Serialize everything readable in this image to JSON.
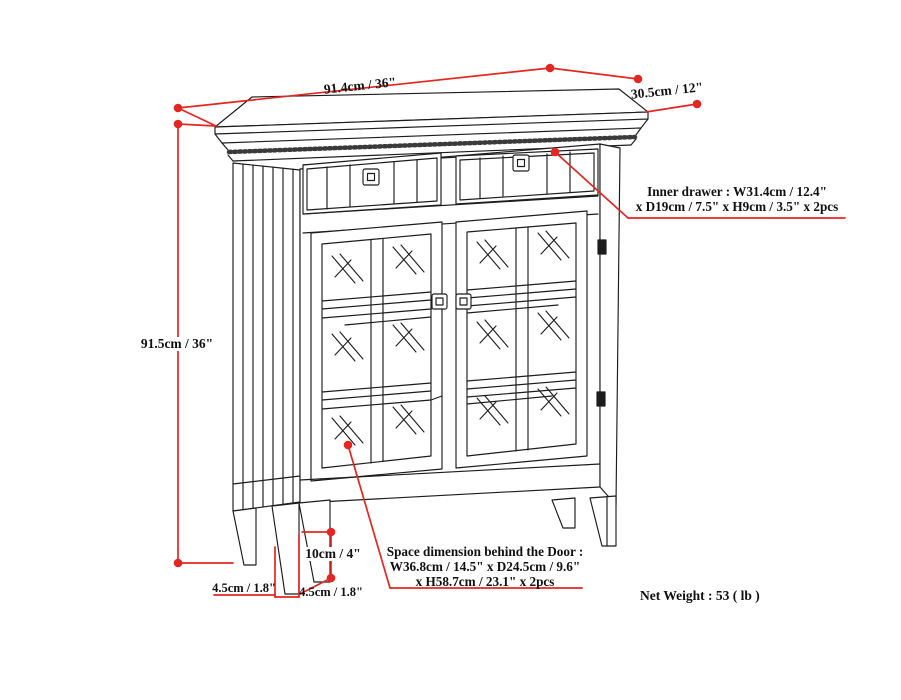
{
  "diagram": {
    "title_hint": "cabinet dimension drawing",
    "colors": {
      "background": "#ffffff",
      "line_art": "#1c1c1c",
      "dimension_red": "#e52620"
    },
    "dimensions": {
      "top_width": "91.4cm / 36\"",
      "top_depth": "30.5cm / 12\"",
      "side_height": "91.5cm / 36\"",
      "leg_height": "10cm / 4\"",
      "leg_width_left": "4.5cm / 1.8\"",
      "leg_width_right": "4.5cm / 1.8\""
    },
    "callouts": {
      "inner_drawer": {
        "line1": "Inner drawer : W31.4cm / 12.4\"",
        "line2": "x D19cm / 7.5\" x H9cm / 3.5\" x 2pcs"
      },
      "space_behind_door": {
        "line1": "Space dimension behind the Door :",
        "line2": "W36.8cm / 14.5\" x D24.5cm / 9.6\"",
        "line3": "x H58.7cm / 23.1\" x 2pcs"
      }
    },
    "net_weight": "Net Weight : 53 ( lb )"
  }
}
